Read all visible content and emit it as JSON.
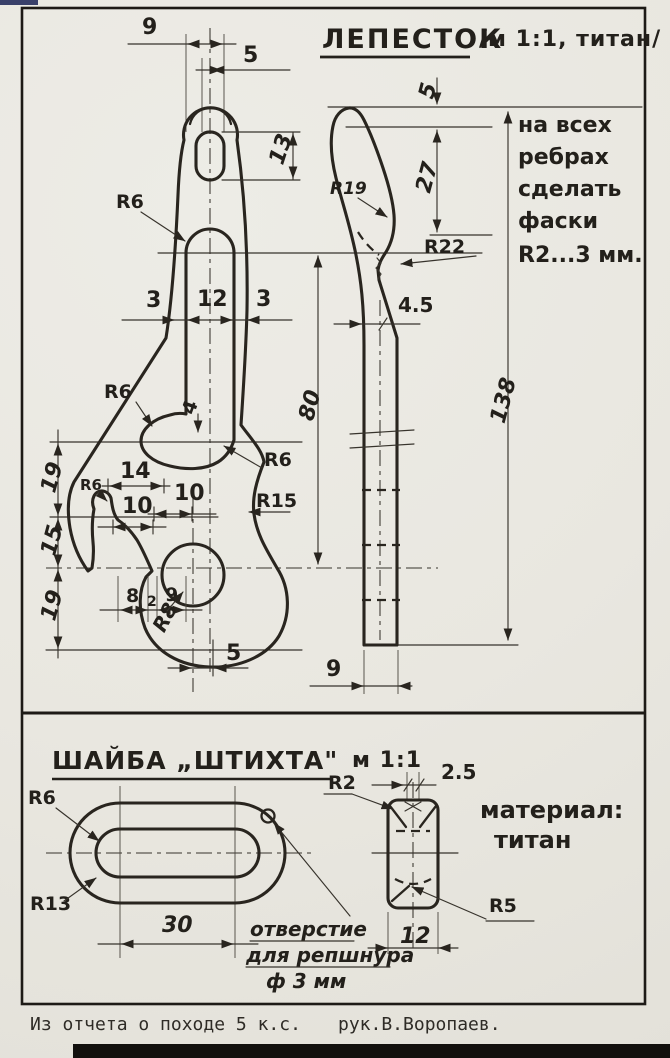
{
  "page": {
    "caption_left": "Из отчета о походе 5 к.с.",
    "caption_right": "рук.В.Воропаев.",
    "ink": "#29251f",
    "paper": "#eae8e1"
  },
  "petal": {
    "title": "ЛЕПЕСТОК",
    "title_suffix": "/м 1:1, титан/",
    "note_lines": [
      "на всех",
      "ребрах",
      "сделать",
      "фаски",
      "R2...3 мм."
    ],
    "dims": {
      "t9": "9",
      "t5": "5",
      "hole13": "13",
      "r6_slot": "R6",
      "w3l": "3",
      "w12": "12",
      "w3r": "3",
      "len80": "80",
      "r6_cav": "R6",
      "step4": "4",
      "r6_cor": "R6",
      "w14": "14",
      "w10a": "10",
      "w10b": "10",
      "r15": "R15",
      "v19a": "19",
      "v15": "15",
      "v19b": "19",
      "b8": "8",
      "b2": "2",
      "b9": "9",
      "r8": "R8",
      "off5": "5",
      "s5": "5",
      "s27": "27",
      "r19": "R19",
      "r22": "R22",
      "t45": "4.5",
      "s138": "138",
      "s9": "9"
    }
  },
  "washer": {
    "title": "ШАЙБА „ШТИХТА\"",
    "scale": "м 1:1",
    "note_lines": [
      "отверстие",
      "для репшнура",
      "ф 3 мм"
    ],
    "material_lines": [
      "материал:",
      "титан"
    ],
    "dims": {
      "r6": "R6",
      "r13": "R13",
      "len30": "30",
      "r2": "R2",
      "t25": "2.5",
      "r5": "R5",
      "w12": "12"
    }
  }
}
